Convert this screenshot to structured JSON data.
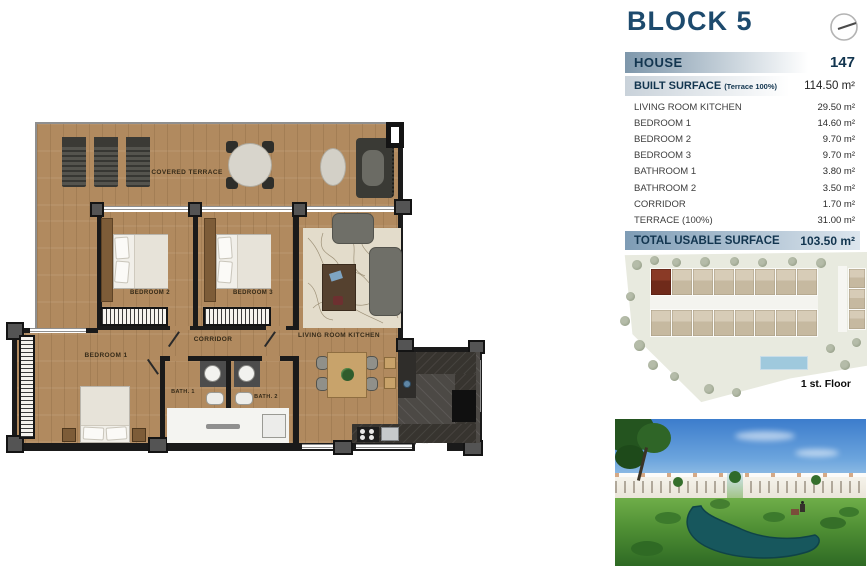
{
  "header": {
    "block_title": "BLOCK 5",
    "house_label": "HOUSE",
    "house_number": "147",
    "compass_icon": "compass-icon"
  },
  "surface_table": {
    "built_label": "BUILT SURFACE",
    "built_note": "(Terrace 100%)",
    "built_value": "114.50 m²",
    "rows": [
      {
        "label": "LIVING ROOM KITCHEN",
        "value": "29.50 m²"
      },
      {
        "label": "BEDROOM 1",
        "value": "14.60 m²"
      },
      {
        "label": "BEDROOM 2",
        "value": "9.70 m²"
      },
      {
        "label": "BEDROOM 3",
        "value": "9.70 m²"
      },
      {
        "label": "BATHROOM 1",
        "value": "3.80 m²"
      },
      {
        "label": "BATHROOM 2",
        "value": "3.50 m²"
      },
      {
        "label": "CORRIDOR",
        "value": "1.70 m²"
      },
      {
        "label": "TERRACE (100%)",
        "value": "31.00 m²"
      }
    ],
    "total_label": "TOTAL USABLE SURFACE",
    "total_value": "103.50 m²"
  },
  "floorplan": {
    "labels": {
      "covered_terrace": "COVERED TERRACE",
      "bedroom1": "BEDROOM 1",
      "bedroom2": "BEDROOM 2",
      "bedroom3": "BEDROOM 3",
      "corridor": "CORRIDOR",
      "living": "LIVING ROOM KITCHEN",
      "bath1": "BATH. 1",
      "bath2": "BATH. 2"
    }
  },
  "site_plan": {
    "caption": "1 st. Floor"
  },
  "colors": {
    "title_navy": "#1d4a6d",
    "bar_blue": "#7e97ab",
    "wood": "#b18a5f",
    "highlight_unit": "#7c2e1d",
    "pool_blue": "#9fc9dd"
  }
}
